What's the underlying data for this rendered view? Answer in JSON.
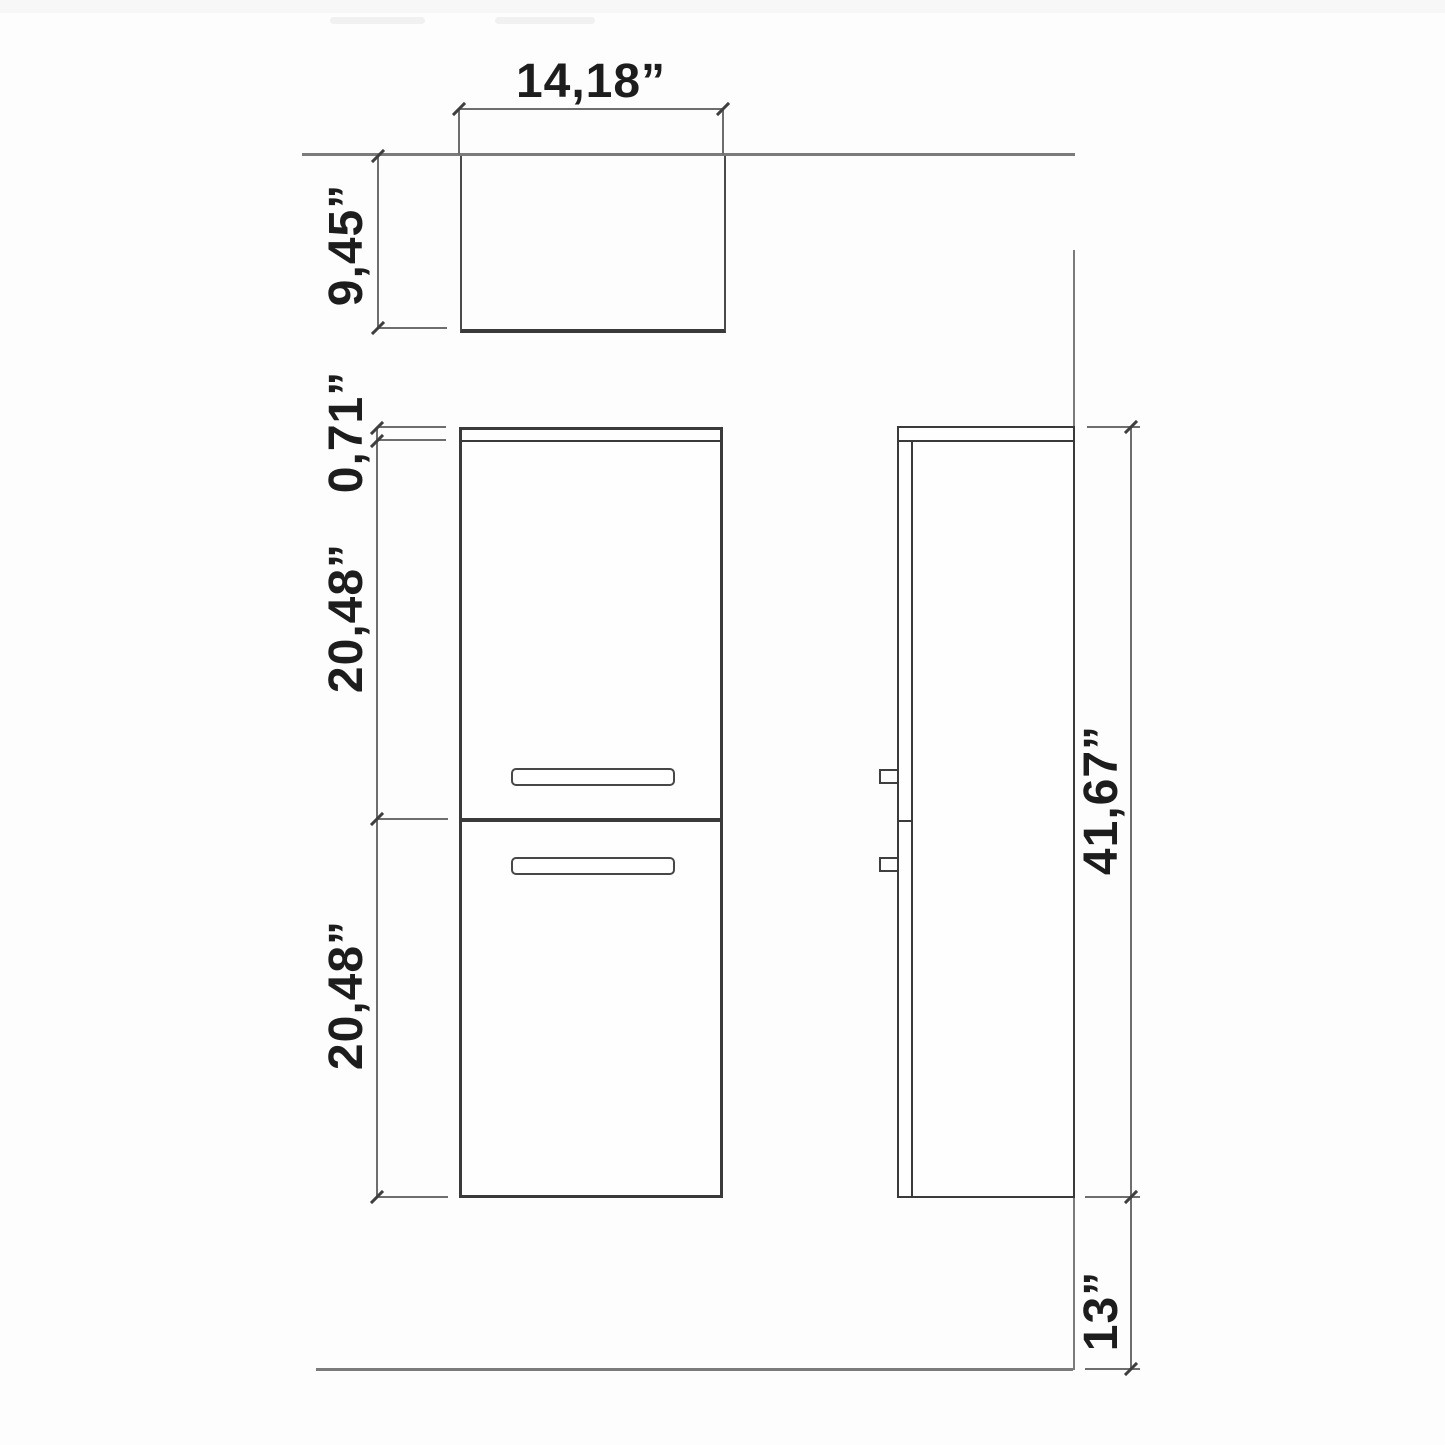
{
  "drawing": {
    "dimensions": {
      "top_width": "14,18”",
      "top_depth": "9,45”",
      "front_top_panel": "0,71”",
      "front_upper_door": "20,48”",
      "front_lower_door": "20,48”",
      "side_total_height": "41,67”",
      "side_floor_clearance": "13”"
    },
    "colors": {
      "outline": "#3a3a3a",
      "dimension_line": "#6e6e6e",
      "reference_line": "#7b7b7b",
      "text": "#1d1d1d",
      "background": "#fdfdfd"
    }
  }
}
